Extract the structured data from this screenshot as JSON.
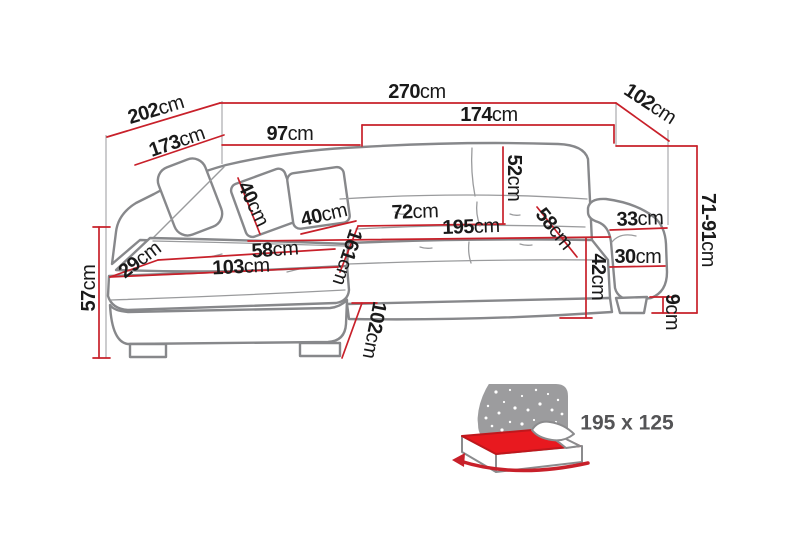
{
  "diagram": {
    "kind": "corner-sofa-dimension-diagram",
    "unit": "cm",
    "dims": {
      "d202": {
        "value": "202",
        "unit": "cm"
      },
      "d270": {
        "value": "270",
        "unit": "cm"
      },
      "d102top": {
        "value": "102",
        "unit": "cm"
      },
      "d173": {
        "value": "173",
        "unit": "cm"
      },
      "d97": {
        "value": "97",
        "unit": "cm"
      },
      "d174": {
        "value": "174",
        "unit": "cm"
      },
      "d52": {
        "value": "52",
        "unit": "cm"
      },
      "d40_pillow_left": {
        "value": "40",
        "unit": "cm"
      },
      "d40_pillow_right": {
        "value": "40",
        "unit": "cm"
      },
      "d72": {
        "value": "72",
        "unit": "cm"
      },
      "d195": {
        "value": "195",
        "unit": "cm"
      },
      "d58_seat": {
        "value": "58",
        "unit": "cm"
      },
      "d33": {
        "value": "33",
        "unit": "cm"
      },
      "d30": {
        "value": "30",
        "unit": "cm"
      },
      "d42": {
        "value": "42",
        "unit": "cm"
      },
      "d71_91": {
        "value": "71-91",
        "unit": "cm"
      },
      "d9": {
        "value": "9",
        "unit": "cm"
      },
      "d29": {
        "value": "29",
        "unit": "cm"
      },
      "d58_chaise": {
        "value": "58",
        "unit": "cm"
      },
      "d103": {
        "value": "103",
        "unit": "cm"
      },
      "d161": {
        "value": "161",
        "unit": "cm"
      },
      "d57": {
        "value": "57",
        "unit": "cm"
      },
      "d102_side": {
        "value": "102",
        "unit": "cm"
      }
    },
    "sleeping_area": {
      "label": "195 x 125"
    },
    "colors": {
      "dimension_red": "#c8202a",
      "outline_gray": "#87888b",
      "seam_gray": "#9a9b9d",
      "icon_gray": "#9c9c9e",
      "mattress_red": "#e8191f",
      "text": "#1a1a1a",
      "badge_text": "#545456"
    }
  }
}
